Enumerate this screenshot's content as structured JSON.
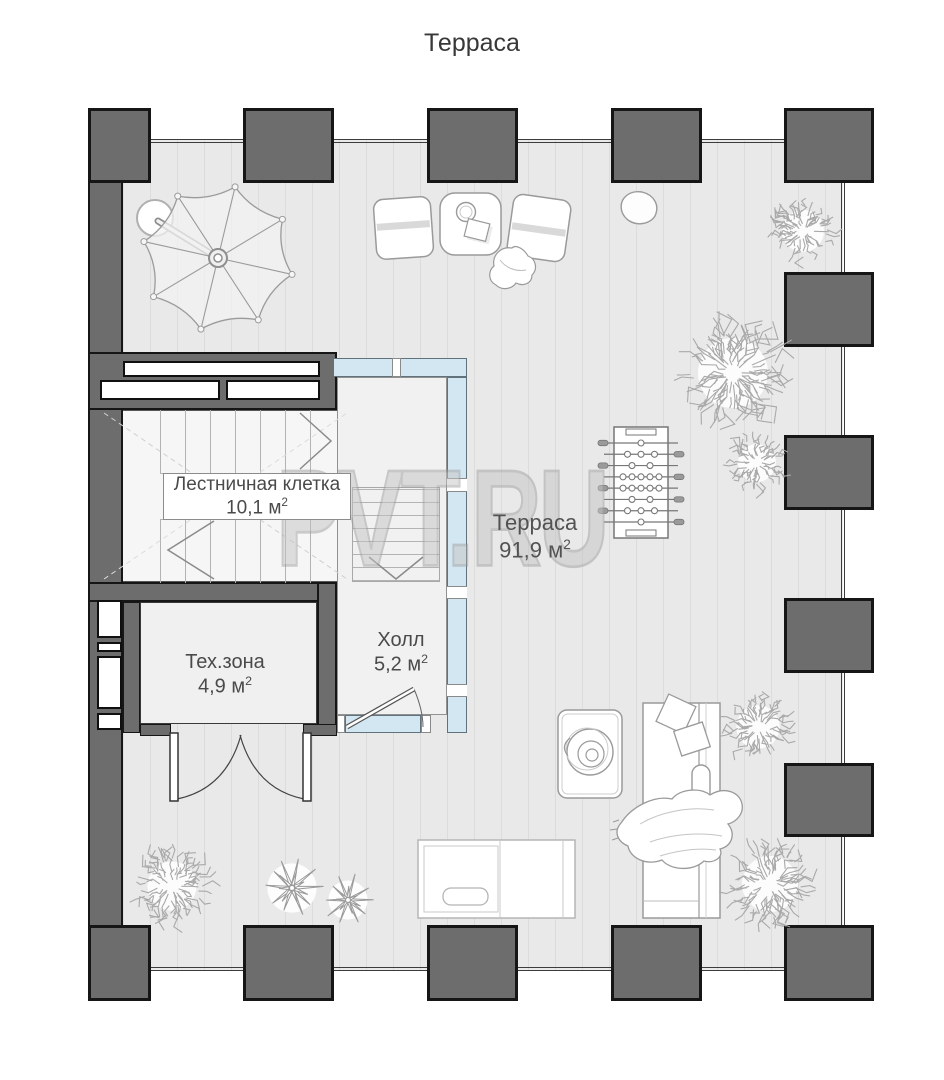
{
  "title": "Терраса",
  "watermark": "PVT.RU",
  "rooms": [
    {
      "name": "Лестничная клетка",
      "area": "10,1",
      "unit": "м",
      "sup": "2"
    },
    {
      "name": "Терраса",
      "area": "91,9",
      "unit": "м",
      "sup": "2"
    },
    {
      "name": "Тех.зона",
      "area": "4,9",
      "unit": "м",
      "sup": "2"
    },
    {
      "name": "Холл",
      "area": "5,2",
      "unit": "м",
      "sup": "2"
    }
  ],
  "colors": {
    "wall": "#6d6d6d",
    "wall_border": "#161616",
    "deck": "#e9e9e9",
    "deck_stripe": "#dcdcdc",
    "glazing": "#d3e7f2",
    "sketch": "#9a9a9a",
    "tree": "#a9a9a9",
    "label_text": "#4a4a4a",
    "watermark": "#c4c4c4"
  },
  "plan": {
    "umbrella": {
      "cx": 218,
      "cy": 258,
      "rx": 76,
      "ry": 73,
      "ribs": 8,
      "rot": -77,
      "pole": {
        "x2": 158,
        "y2": 221
      },
      "base": {
        "cx": 155,
        "cy": 218,
        "r": 18
      }
    },
    "foosball": {
      "x": 614,
      "y": 427,
      "w": 54,
      "h": 111,
      "rods": 8,
      "players": [
        1,
        3,
        2,
        5,
        5,
        2,
        3,
        1
      ]
    },
    "trees": [
      {
        "cx": 803,
        "cy": 231,
        "r": 30
      },
      {
        "cx": 733,
        "cy": 373,
        "r": 50
      },
      {
        "cx": 757,
        "cy": 463,
        "r": 27
      },
      {
        "cx": 758,
        "cy": 727,
        "r": 31
      },
      {
        "cx": 770,
        "cy": 884,
        "r": 40
      },
      {
        "cx": 172,
        "cy": 886,
        "r": 35
      }
    ],
    "agaves": [
      {
        "cx": 292,
        "cy": 888,
        "r": 29
      },
      {
        "cx": 348,
        "cy": 900,
        "r": 23
      }
    ]
  }
}
